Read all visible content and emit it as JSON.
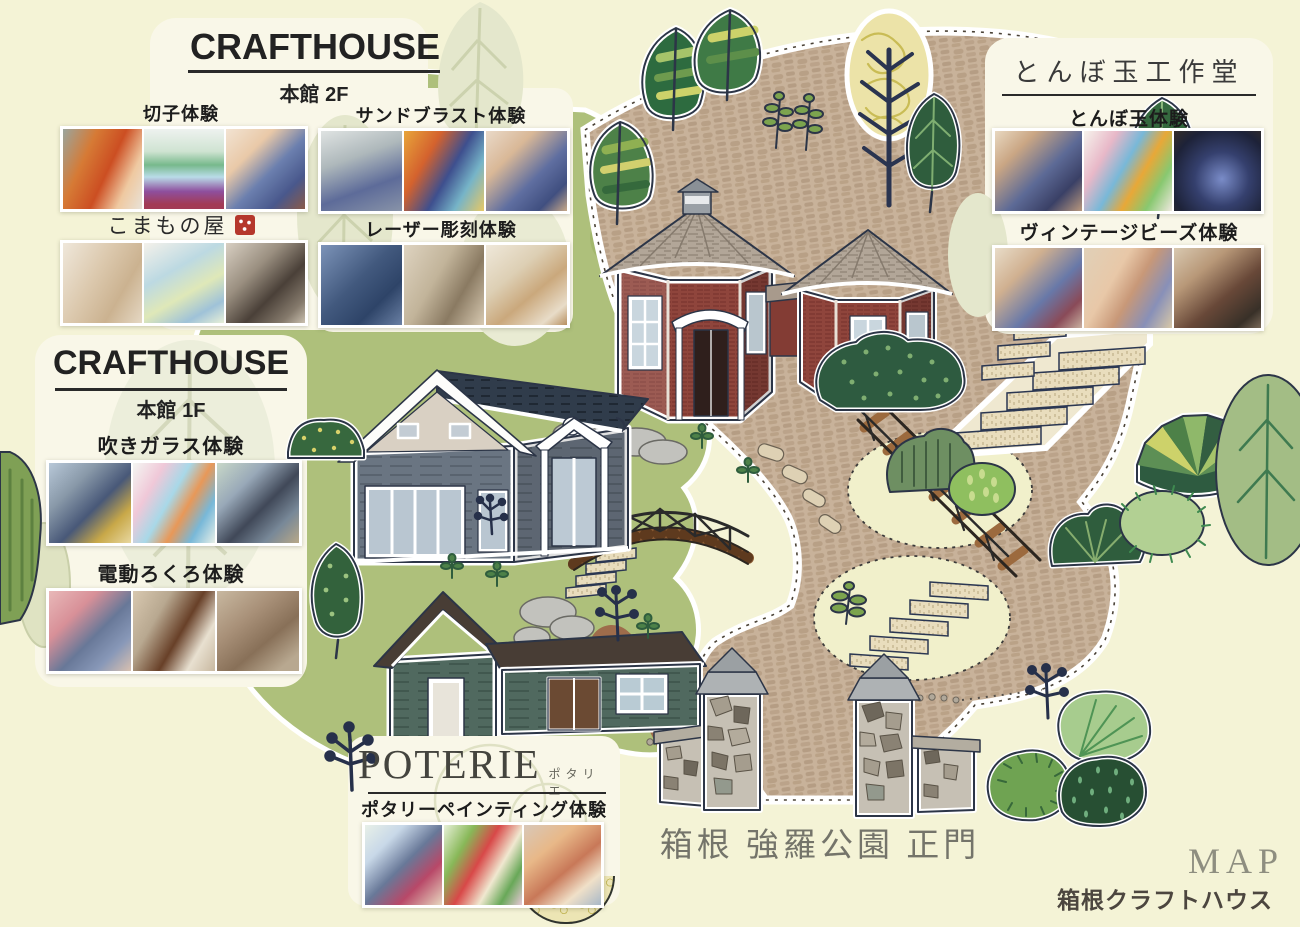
{
  "brand": {
    "map_title": "MAP",
    "name": "箱根クラフトハウス"
  },
  "gate": {
    "label": "箱根 強羅公園 正門"
  },
  "panels": {
    "crafthouse_2f": {
      "title": "CRAFTHOUSE",
      "floor": "本館 2F",
      "kiriko_label": "切子体験",
      "komamono_label": "こまもの屋",
      "sandblast_label": "サンドブラスト体験",
      "laser_label": "レーザー彫刻体験"
    },
    "tonbodama_studio": {
      "title": "とんぼ玉工作堂",
      "tonbodama_label": "とんぼ玉体験",
      "vintage_beads_label": "ヴィンテージビーズ体験"
    },
    "crafthouse_1f": {
      "title": "CRAFTHOUSE",
      "floor": "本館 1F",
      "glassblowing_label": "吹きガラス体験",
      "pottery_wheel_label": "電動ろくろ体験"
    },
    "poterie": {
      "title": "POTERIE",
      "ruby": "ポタリエ",
      "painting_label": "ポタリーペインティング体験"
    }
  },
  "colors": {
    "background": "#f4f3d6",
    "lawn_green": "#aec07b",
    "path_tan": "#c8b29a",
    "brick_red": "#8f453c",
    "house_gray": "#6a7582",
    "poterie_green": "#50695f",
    "seal_red": "#b5372c",
    "ink_navy": "#2c3547"
  }
}
